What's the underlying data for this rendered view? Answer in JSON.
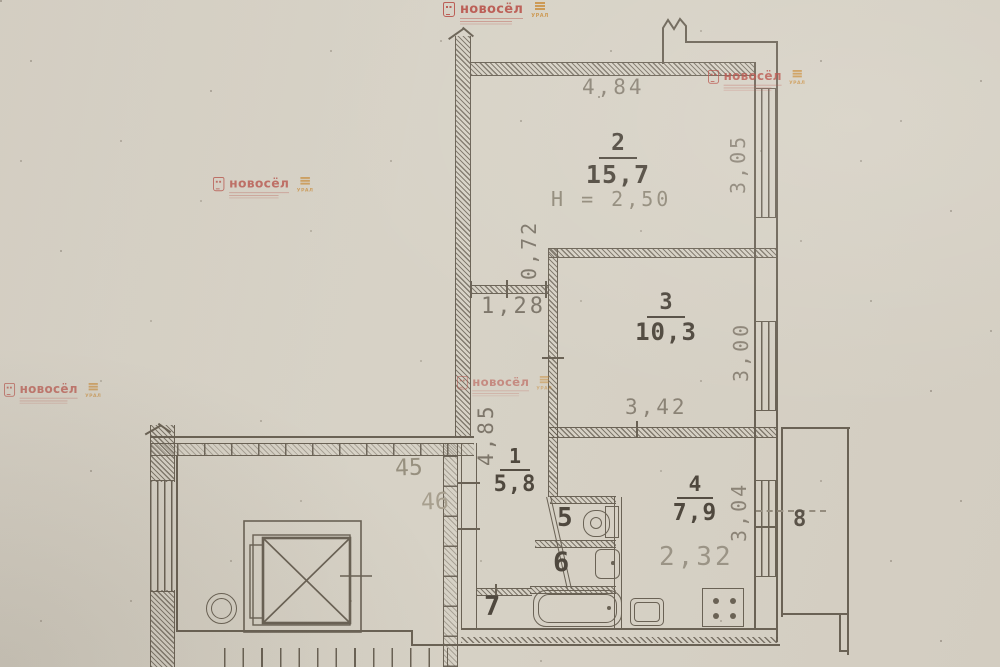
{
  "watermark": {
    "brand": "новосёл",
    "region": "УРАЛ"
  },
  "plan": {
    "rooms": {
      "r1": {
        "number": "1",
        "area": "5,8"
      },
      "r2": {
        "number": "2",
        "area": "15,7",
        "height": "Н = 2,50"
      },
      "r3": {
        "number": "3",
        "area": "10,3"
      },
      "r4": {
        "number": "4",
        "area": "7,9"
      },
      "r5": {
        "number": "5"
      },
      "r6": {
        "number": "6"
      },
      "r7": {
        "number": "7"
      },
      "r8": {
        "number": "8"
      }
    },
    "dimensions": {
      "top_width": "4,84",
      "room2_right": "3,05",
      "corridor_door": "0,72",
      "corridor_width": "1,28",
      "corridor_length": "4,85",
      "room3_right": "3,00",
      "room3_bottom": "3,42",
      "kitchen_width": "2,32",
      "kitchen_right": "3,04"
    },
    "unit_numbers": {
      "a": "45",
      "b": "46"
    }
  },
  "colors": {
    "ink": "#6a6255",
    "label": "#4f483e",
    "dim_text": "#8b8376",
    "brand_red": "#b5473f",
    "brand_orange": "#c98c3a",
    "paper": "#d7d2c7"
  }
}
